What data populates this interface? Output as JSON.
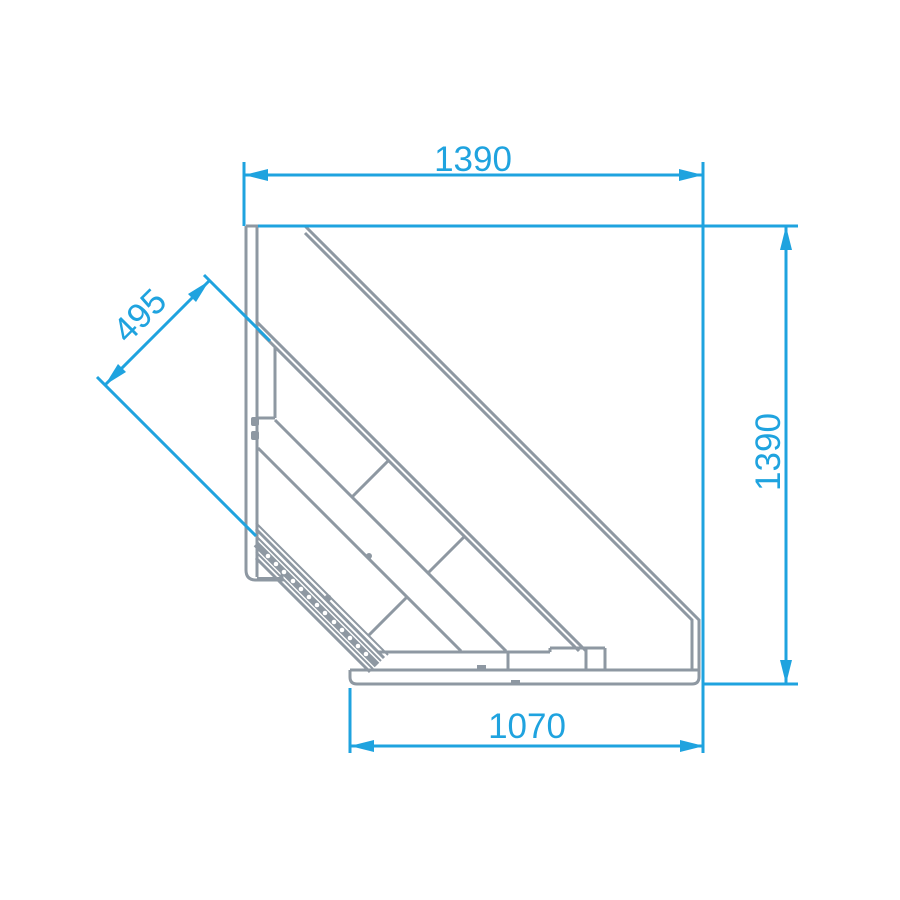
{
  "drawing": {
    "type": "technical-dimension-drawing",
    "view": "corner-counter-section",
    "dimensions": {
      "top_width": {
        "value": "1390",
        "orientation": "horizontal"
      },
      "right_height": {
        "value": "1390",
        "orientation": "vertical"
      },
      "front_depth": {
        "value": "495",
        "orientation": "diagonal-45"
      },
      "bottom_width": {
        "value": "1070",
        "orientation": "horizontal"
      }
    },
    "colors": {
      "dimension_blue": "#1FA3DF",
      "structure_gray": "#8E98A2",
      "background": "#FFFFFF"
    }
  }
}
